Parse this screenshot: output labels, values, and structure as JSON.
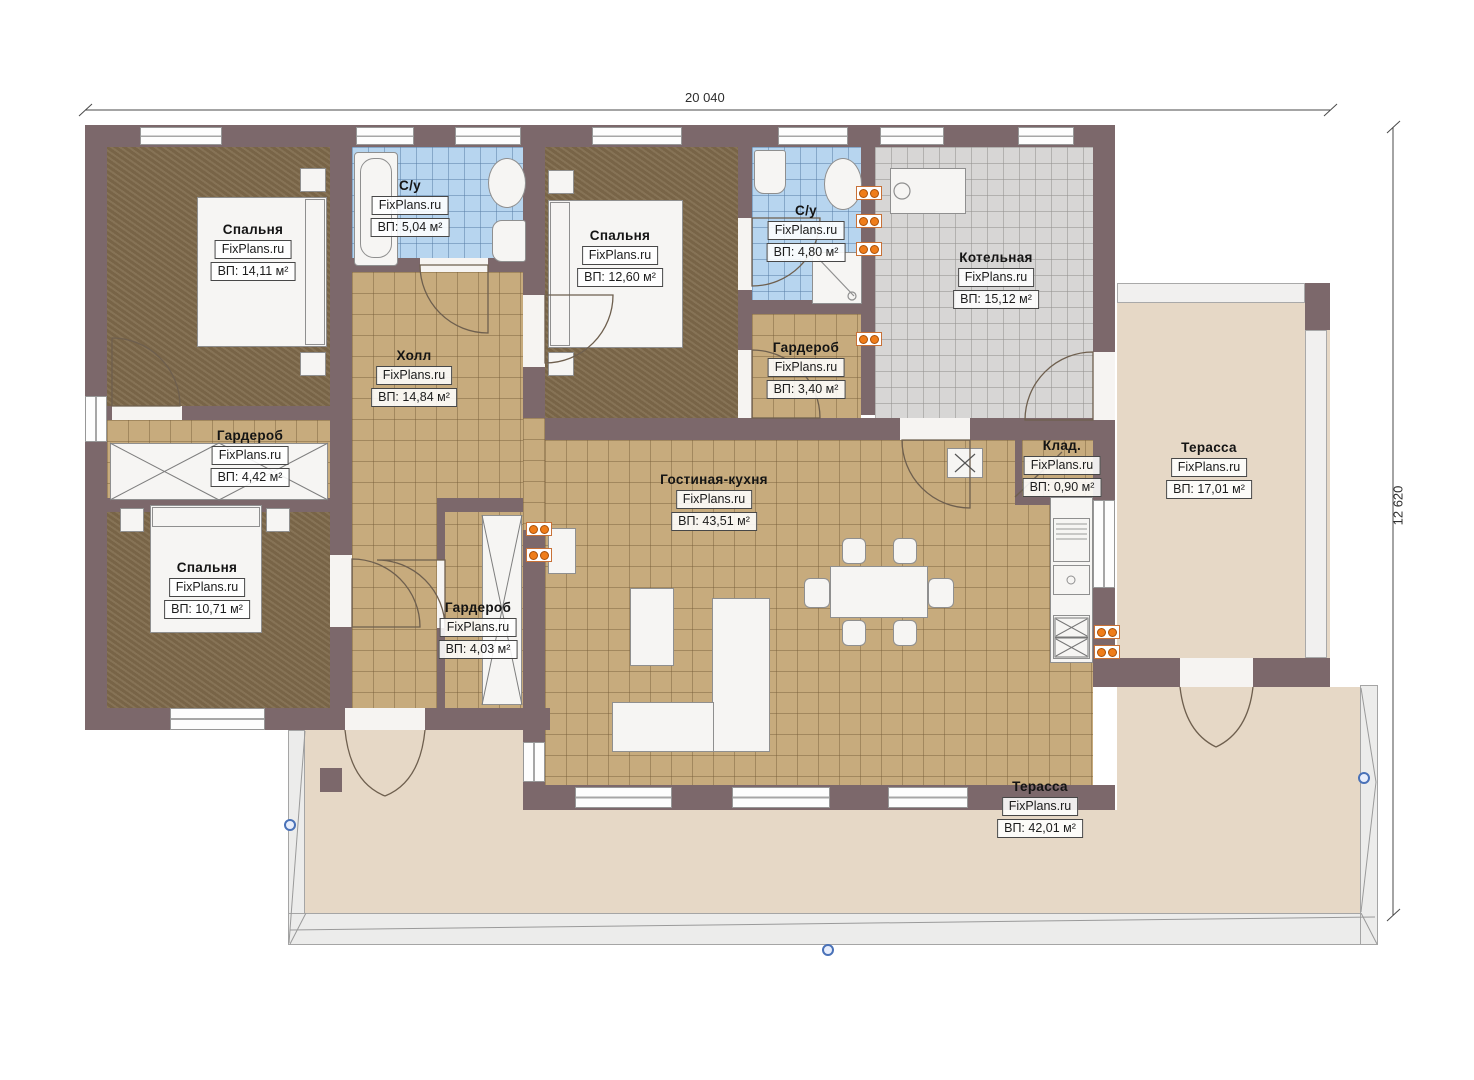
{
  "plan": {
    "dimensions": {
      "width_label": "20 040",
      "height_label": "12 620"
    },
    "watermark": "FixPlans.ru",
    "rooms": [
      {
        "name": "Спальня",
        "watermark": "FixPlans.ru",
        "area": "ВП: 14,11 м²"
      },
      {
        "name": "С/у",
        "watermark": "FixPlans.ru",
        "area": "ВП: 5,04 м²"
      },
      {
        "name": "Спальня",
        "watermark": "FixPlans.ru",
        "area": "ВП: 12,60 м²"
      },
      {
        "name": "С/у",
        "watermark": "FixPlans.ru",
        "area": "ВП: 4,80 м²"
      },
      {
        "name": "Котельная",
        "watermark": "FixPlans.ru",
        "area": "ВП: 15,12 м²"
      },
      {
        "name": "Холл",
        "watermark": "FixPlans.ru",
        "area": "ВП: 14,84 м²"
      },
      {
        "name": "Гардероб",
        "watermark": "FixPlans.ru",
        "area": "ВП: 3,40 м²"
      },
      {
        "name": "Гардероб",
        "watermark": "FixPlans.ru",
        "area": "ВП: 4,42 м²"
      },
      {
        "name": "Клад.",
        "watermark": "FixPlans.ru",
        "area": "ВП: 0,90 м²"
      },
      {
        "name": "Терасса",
        "watermark": "FixPlans.ru",
        "area": "ВП: 17,01 м²"
      },
      {
        "name": "Гостиная-кухня",
        "watermark": "FixPlans.ru",
        "area": "ВП: 43,51 м²"
      },
      {
        "name": "Спальня",
        "watermark": "FixPlans.ru",
        "area": "ВП: 10,71 м²"
      },
      {
        "name": "Гардероб",
        "watermark": "FixPlans.ru",
        "area": "ВП: 4,03 м²"
      },
      {
        "name": "Терасса",
        "watermark": "FixPlans.ru",
        "area": "ВП: 42,01 м²"
      }
    ],
    "colors": {
      "wall": "#7c686b",
      "bedroom_floor": "#7f6a4b",
      "tile_floor": "#c7ab7d",
      "bathroom_floor": "#b7d5ef",
      "boiler_floor": "#d7d6d5",
      "terrace_floor": "#e6d8c6",
      "radiator": "#ef7d1a",
      "marker": "#4a72b8"
    }
  }
}
